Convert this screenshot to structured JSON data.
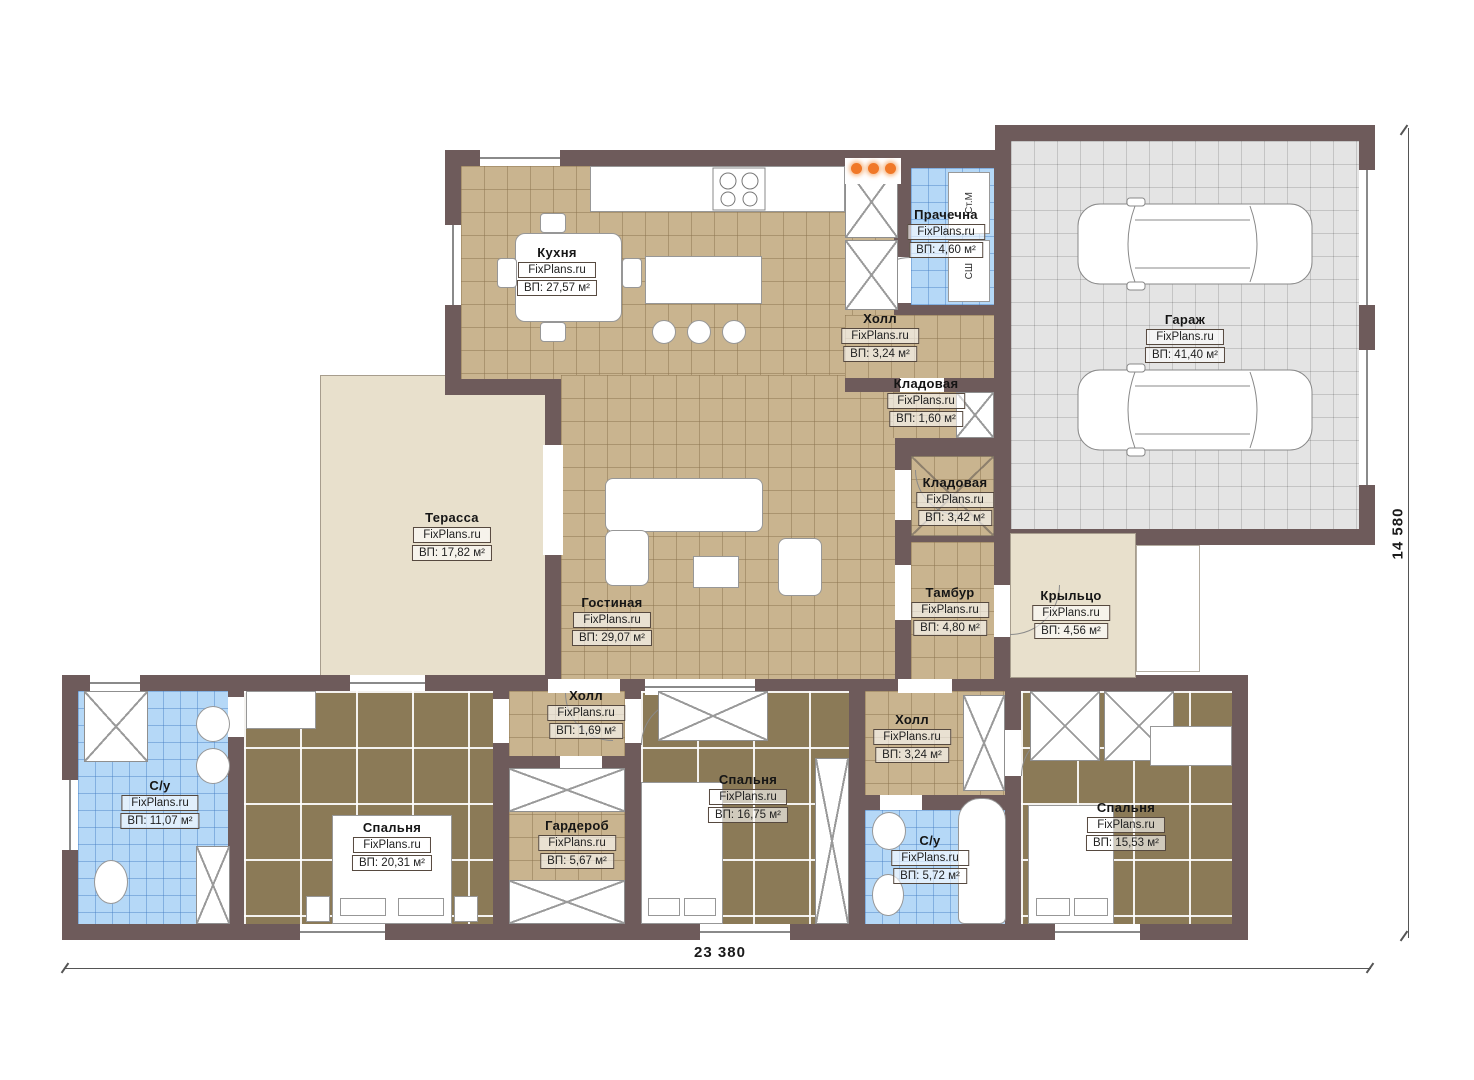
{
  "plan": {
    "watermark": "FixPlans.ru",
    "dimensions": {
      "width_label": "23 380",
      "height_label": "14 580"
    },
    "colors": {
      "wall": "#6e5b5b",
      "tile_tan": "#c9b48f",
      "floor_brown": "#8b7a57",
      "tile_blue": "#b5d8f7",
      "garage_gray": "#e4e4e4",
      "terrace_beige": "#e8e0cc",
      "pendant_orange": "#f07828"
    },
    "rooms": [
      {
        "id": "kitchen",
        "name": "Кухня",
        "area": "ВП: 27,57 м²"
      },
      {
        "id": "laundry",
        "name": "Прачечна",
        "area": "ВП: 4,60 м²"
      },
      {
        "id": "hall-top",
        "name": "Холл",
        "area": "ВП: 3,24 м²"
      },
      {
        "id": "storage-small",
        "name": "Кладовая",
        "area": "ВП: 1,60 м²"
      },
      {
        "id": "garage",
        "name": "Гараж",
        "area": "ВП: 41,40 м²"
      },
      {
        "id": "storage",
        "name": "Кладовая",
        "area": "ВП: 3,42 м²"
      },
      {
        "id": "terrace",
        "name": "Терасса",
        "area": "ВП: 17,82 м²"
      },
      {
        "id": "living",
        "name": "Гостиная",
        "area": "ВП: 29,07 м²"
      },
      {
        "id": "vestibule",
        "name": "Тамбур",
        "area": "ВП: 4,80 м²"
      },
      {
        "id": "porch",
        "name": "Крыльцо",
        "area": "ВП: 4,56 м²"
      },
      {
        "id": "bath-left",
        "name": "С/у",
        "area": "ВП: 11,07 м²"
      },
      {
        "id": "bedroom-left",
        "name": "Спальня",
        "area": "ВП: 20,31 м²"
      },
      {
        "id": "hall-small",
        "name": "Холл",
        "area": "ВП: 1,69 м²"
      },
      {
        "id": "wardrobe",
        "name": "Гардероб",
        "area": "ВП: 5,67 м²"
      },
      {
        "id": "bedroom-mid",
        "name": "Спальня",
        "area": "ВП: 16,75 м²"
      },
      {
        "id": "hall-bottom",
        "name": "Холл",
        "area": "ВП: 3,24 м²"
      },
      {
        "id": "bath-mid",
        "name": "С/у",
        "area": "ВП: 5,72 м²"
      },
      {
        "id": "bedroom-right",
        "name": "Спальня",
        "area": "ВП: 15,53 м²"
      }
    ],
    "appliances": {
      "washer": "Ст.М",
      "dryer": "СШ"
    }
  }
}
